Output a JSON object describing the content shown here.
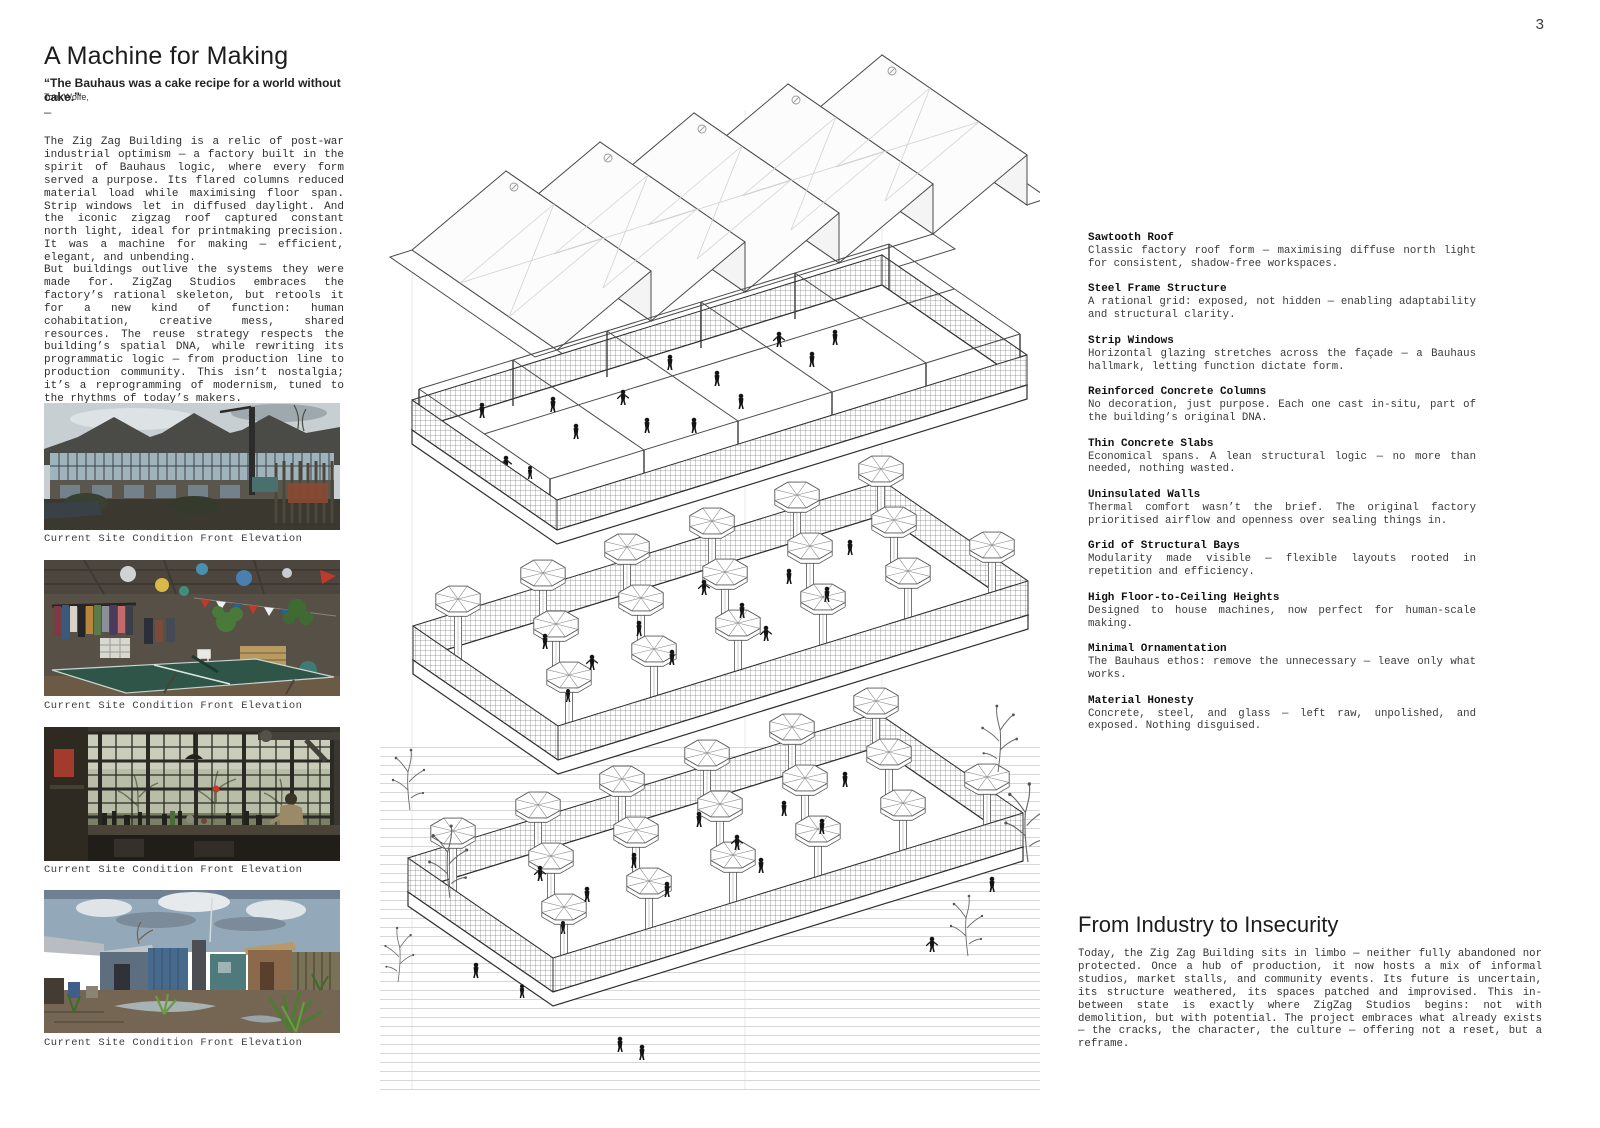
{
  "page": {
    "number": "3"
  },
  "intro": {
    "title": "A Machine for Making",
    "quote": "“The Bauhaus was a cake recipe for a world without cake.”",
    "attribution": "Tom Wolfe,",
    "divider": "—",
    "paragraph1": "The Zig Zag Building is a relic of post-war industrial optimism — a factory built in the spirit of Bauhaus logic, where every form served a purpose. Its flared columns reduced material load while maximising floor span. Strip windows let in diffused daylight. And the iconic zigzag roof captured constant north light, ideal for printmaking precision. It was a machine for making — efficient, elegant, and unbending.",
    "paragraph2": "But buildings outlive the systems they were made for. ZigZag Studios embraces the factory’s rational skeleton, but retools it for a new kind of function: human cohabitation, creative mess, shared resources. The reuse strategy respects the building’s spatial DNA, while rewriting its programmatic logic — from production line to production community. This isn’t nostalgia; it’s a reprogramming of modernism, tuned to the rhythms of today’s makers."
  },
  "photos": [
    {
      "caption": "Current Site Condition Front Elevation"
    },
    {
      "caption": "Current Site Condition Front Elevation"
    },
    {
      "caption": "Current Site Condition Front Elevation"
    },
    {
      "caption": "Current Site Condition Front Elevation"
    }
  ],
  "annotations": {
    "items": [
      {
        "title": "Sawtooth Roof",
        "body": "Classic factory roof form — maximising diffuse north light for consistent, shadow-free workspaces."
      },
      {
        "title": "Steel Frame Structure",
        "body": "A rational grid: exposed, not hidden — enabling adaptability and structural clarity."
      },
      {
        "title": "Strip Windows",
        "body": "Horizontal glazing stretches across the façade — a Bauhaus hallmark, letting function dictate form."
      },
      {
        "title": "Reinforced Concrete Columns",
        "body": "No decoration, just purpose. Each one cast in-situ, part of the building’s original DNA."
      },
      {
        "title": "Thin Concrete Slabs",
        "body": "Economical spans. A lean structural logic — no more than needed, nothing wasted."
      },
      {
        "title": "Uninsulated Walls",
        "body": "Thermal comfort wasn’t the brief. The original factory prioritised airflow and openness over sealing things in."
      },
      {
        "title": "Grid of Structural Bays",
        "body": "Modularity made visible — flexible layouts rooted in repetition and efficiency."
      },
      {
        "title": "High Floor-to-Ceiling Heights",
        "body": "Designed to house machines, now perfect for human-scale making."
      },
      {
        "title": "Minimal Ornamentation",
        "body": "The Bauhaus ethos: remove the unnecessary — leave only what works."
      },
      {
        "title": "Material Honesty",
        "body": "Concrete, steel, and glass — left raw, unpolished, and exposed. Nothing disguised."
      }
    ]
  },
  "industry": {
    "title": "From Industry to Insecurity",
    "body": "Today, the Zig Zag Building sits in limbo — neither fully abandoned nor protected. Once a hub of production, it now hosts a mix of informal studios, market stalls, and community events. Its future is uncertain, its structure weathered, its spaces patched and improvised. This in-between state is exactly where ZigZag Studios begins: not with demolition, but with potential. The project embraces what already exists — the cracks, the character, the culture — offering not a reset, but a reframe."
  }
}
